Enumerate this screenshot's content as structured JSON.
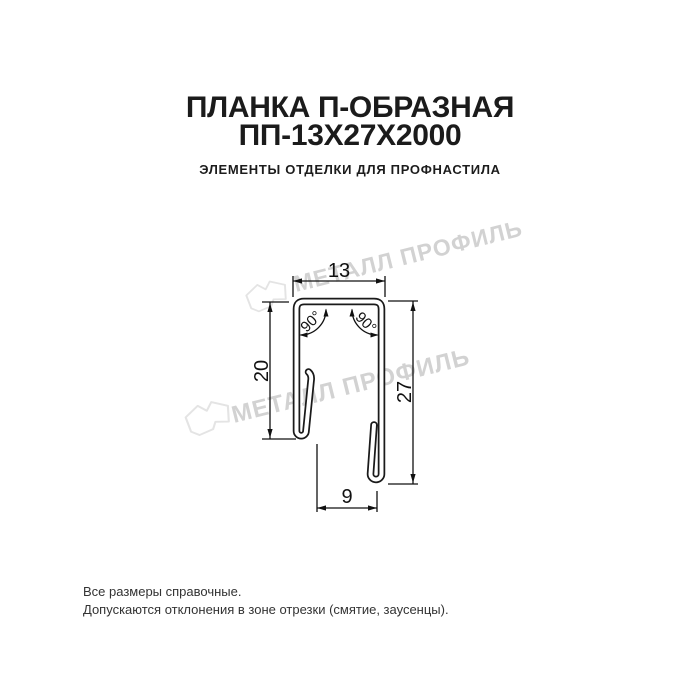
{
  "header": {
    "title_line1": "ПЛАНКА П-ОБРАЗНАЯ",
    "title_line2": "ПП-13Х27Х2000",
    "subtitle": "ЭЛЕМЕНТЫ ОТДЕЛКИ ДЛЯ ПРОФНАСТИЛА"
  },
  "drawing": {
    "type": "dimensioned profile cross-section",
    "dimensions": {
      "top_width": "13",
      "left_height": "20",
      "right_height": "27",
      "bottom_width": "9",
      "angle_left": "90°",
      "angle_right": "90°"
    }
  },
  "watermark": {
    "text": "МЕТАЛЛ ПРОФИЛЬ"
  },
  "footer": {
    "line1": "Все размеры справочные.",
    "line2": "Допускаются отклонения в зоне отрезки (смятие, заусенцы)."
  },
  "colors": {
    "ink": "#1a1a1a",
    "watermark_text": "#d2d2d2",
    "watermark_logo": "#e4e4e4"
  }
}
